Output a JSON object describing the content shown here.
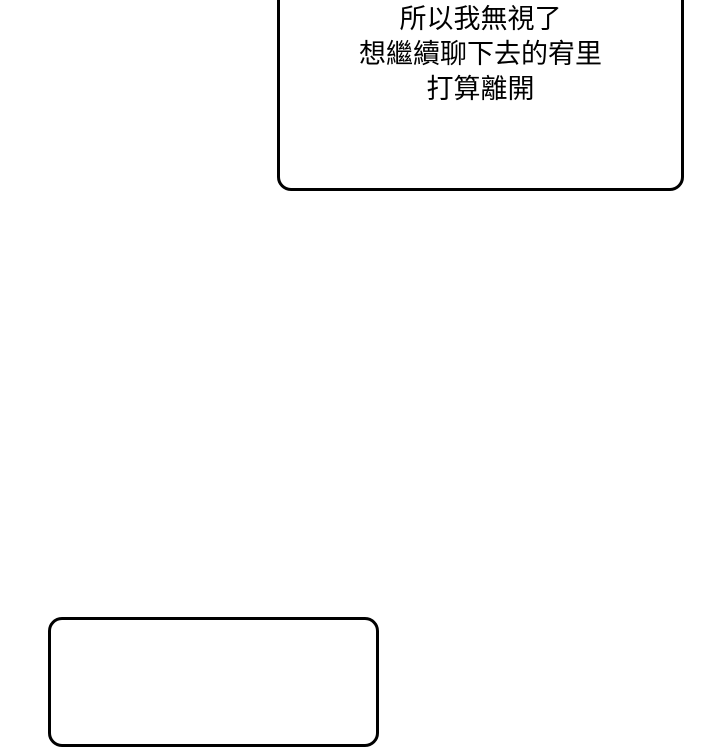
{
  "page": {
    "background_color": "#ffffff",
    "type": "comic-panel"
  },
  "colors": {
    "bubble_border": "#000000",
    "bubble_fill": "#ffffff",
    "text": "#000000"
  },
  "speech_bubbles": {
    "top": {
      "lines": {
        "0": "所以我無視了",
        "1": "想繼續聊下去的宥里",
        "2": "打算離開"
      }
    },
    "bottom": {
      "lines": {}
    }
  }
}
